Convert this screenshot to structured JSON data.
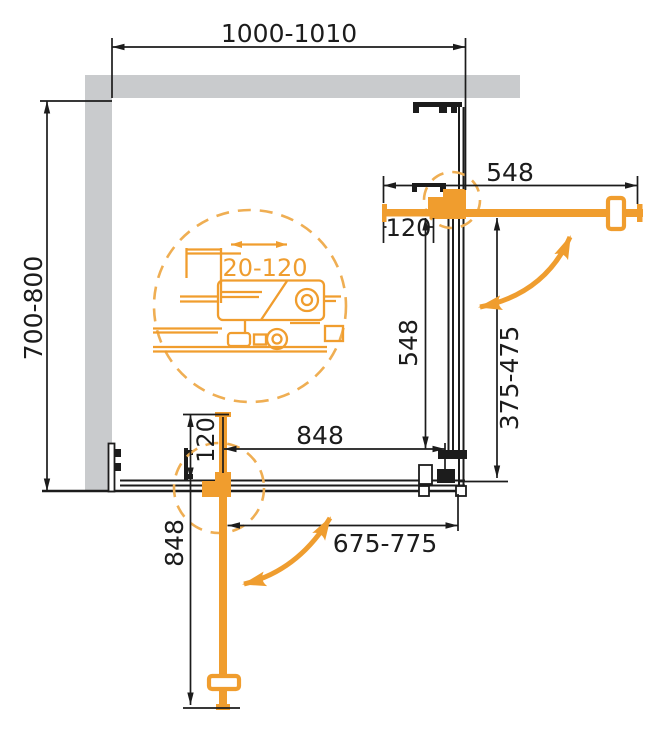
{
  "drawing": {
    "type": "shower-enclosure-corner-plan",
    "colors": {
      "accent_orange": "#f09d2e",
      "accent_orange_light": "#efae53",
      "wall_gray": "#c9cbcd",
      "line_black": "#1c1c1c",
      "background": "#ffffff"
    },
    "dims": {
      "width_top": "1000-1010",
      "depth_left": "700-800",
      "door_right": "548",
      "offset_right": "120",
      "side_right": "548",
      "entry_right": "375-475",
      "span_bottom": "848",
      "offset_bottom": "120",
      "door_bottom": "848",
      "entry_bottom": "675-775",
      "adjustment": "20-120"
    }
  }
}
